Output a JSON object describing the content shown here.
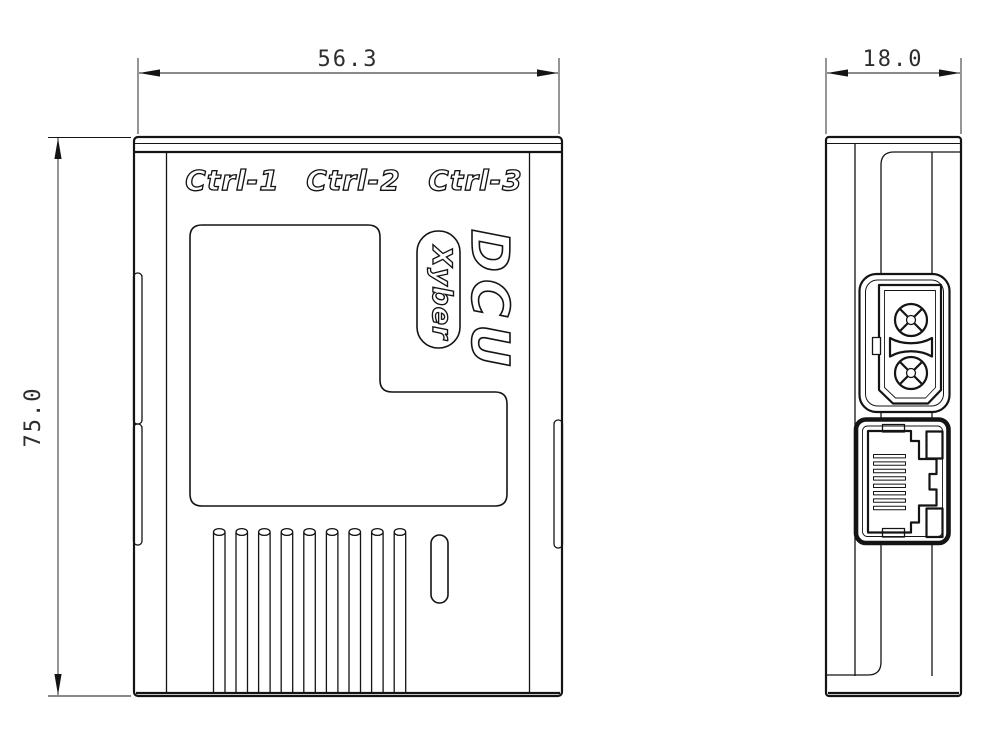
{
  "front_view": {
    "width_dim": "56.3",
    "height_dim": "75.0",
    "port_labels": [
      "Ctrl-1",
      "Ctrl-2",
      "Ctrl-3"
    ],
    "product_name": "DCU",
    "brand_name": "Xyber"
  },
  "side_view": {
    "depth_dim": "18.0"
  },
  "colors": {
    "line": "#141414",
    "background": "#ffffff"
  }
}
